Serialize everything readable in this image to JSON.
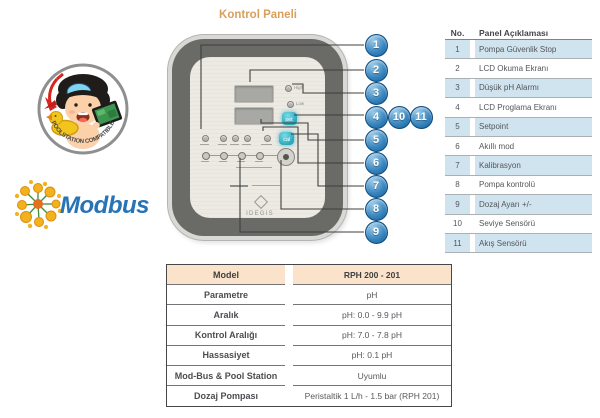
{
  "title": "Kontrol Paneli",
  "badge": {
    "text": "POOLSTATION COMPATIBLE"
  },
  "modbus": {
    "label": "Modbus"
  },
  "device": {
    "brand": "IDEGIS",
    "set_button": "set",
    "cal_button": "cal",
    "high_label": "High",
    "low_label": "Low"
  },
  "callouts": [
    "1",
    "2",
    "3",
    "4",
    "5",
    "6",
    "7",
    "8",
    "9",
    "10",
    "11"
  ],
  "panel_table": {
    "headers": [
      "No.",
      "Panel Açıklaması"
    ],
    "rows": [
      {
        "no": "1",
        "desc": "Pompa Güvenlik Stop"
      },
      {
        "no": "2",
        "desc": "LCD Okuma Ekranı"
      },
      {
        "no": "3",
        "desc": "Düşük pH Alarmı"
      },
      {
        "no": "4",
        "desc": "LCD Proglama Ekranı"
      },
      {
        "no": "5",
        "desc": "Setpoint"
      },
      {
        "no": "6",
        "desc": "Akıllı mod"
      },
      {
        "no": "7",
        "desc": "Kalibrasyon"
      },
      {
        "no": "8",
        "desc": "Pompa kontrolü"
      },
      {
        "no": "9",
        "desc": "Dozaj Ayarı +/-"
      },
      {
        "no": "10",
        "desc": "Seviye Sensörü"
      },
      {
        "no": "11",
        "desc": "Akış Sensörü"
      }
    ]
  },
  "spec_table": {
    "rows": [
      {
        "label": "Model",
        "value": "RPH 200 - 201",
        "header": true
      },
      {
        "label": "Parametre",
        "value": "pH"
      },
      {
        "label": "Aralık",
        "value": "pH: 0.0 - 9.9 pH"
      },
      {
        "label": "Kontrol Aralığı",
        "value": "pH: 7.0 - 7.8 pH"
      },
      {
        "label": "Hassasiyet",
        "value": "pH: 0.1 pH"
      },
      {
        "label": "Mod-Bus & Pool Station",
        "value": "Uyumlu"
      },
      {
        "label": "Dozaj Pompası",
        "value": "Peristaltik 1 L/h - 1.5 bar (RPH 201)"
      }
    ]
  },
  "colors": {
    "accent_orange": "#d99f5c",
    "callout_blue": "#3a87c0",
    "row_blue": "#cfe4ef",
    "spec_header_peach": "#fbe3cb",
    "modbus_blue": "#2673b6",
    "button_cyan": "#2aa9bd"
  }
}
